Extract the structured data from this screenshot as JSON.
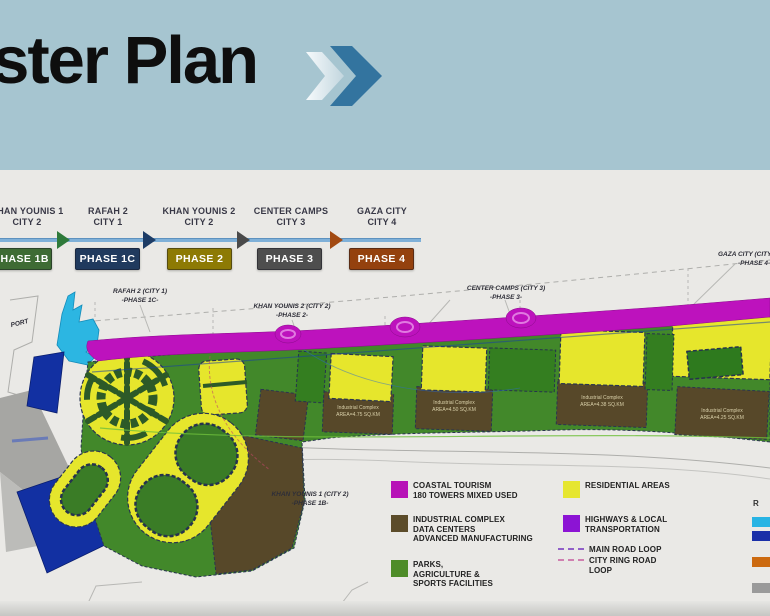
{
  "title": {
    "text": "Master Plan"
  },
  "timeline": {
    "items": [
      {
        "city_line1": "KHAN YOUNIS 1",
        "city_line2": "CITY 2",
        "phase": "PHASE 1B",
        "box_color": "#3e6b34"
      },
      {
        "city_line1": "RAFAH 2",
        "city_line2": "CITY 1",
        "phase": "PHASE 1C",
        "box_color": "#203a5e"
      },
      {
        "city_line1": "KHAN YOUNIS 2",
        "city_line2": "CITY 2",
        "phase": "PHASE 2",
        "box_color": "#8d7a04"
      },
      {
        "city_line1": "CENTER CAMPS",
        "city_line2": "CITY 3",
        "phase": "PHASE 3",
        "box_color": "#4e4e4e"
      },
      {
        "city_line1": "GAZA CITY",
        "city_line2": "CITY 4",
        "phase": "PHASE 4",
        "box_color": "#94410e"
      }
    ]
  },
  "map": {
    "labels": {
      "port": "PORT",
      "rafah_l1": "RAFAH 2 (CITY 1)",
      "rafah_l2": "-PHASE 1C-",
      "ky2_l1": "KHAN YOUNIS 2 (CITY 2)",
      "ky2_l2": "-PHASE 2-",
      "cc_l1": "CENTER CAMPS (CITY 3)",
      "cc_l2": "-PHASE 3-",
      "gaza_l1": "GAZA CITY (CITY 4)",
      "gaza_l2": "-PHASE 4-",
      "ky1_l1": "KHAN YOUNIS 1 (CITY 2)",
      "ky1_l2": "-PHASE 1B-"
    },
    "industrial": [
      {
        "l1": "Industrial Complex",
        "l2": "AREA=4.75 SQ.KM"
      },
      {
        "l1": "Industrial Complex",
        "l2": "AREA=4.50 SQ.KM"
      },
      {
        "l1": "Industrial Complex",
        "l2": "AREA=4.38 SQ.KM"
      },
      {
        "l1": "Industrial Complex",
        "l2": "AREA=4.25 SQ.KM"
      }
    ],
    "region_colors": {
      "coastal_tourism": "#bd12bd",
      "residential": "#e6e62c",
      "parks_agriculture": "#42882a",
      "industrial": "#574829",
      "port_water": "#2cb6e2",
      "blue_zone": "#1230a2",
      "gray_zone": "#a6a6a3"
    }
  },
  "legend": {
    "coastal": {
      "swatch": "#b712b7",
      "l1": "COASTAL TOURISM",
      "l2": "180 TOWERS MIXED USED"
    },
    "residential": {
      "swatch": "#e6e630",
      "l1": "RESIDENTIAL AREAS"
    },
    "industrial": {
      "swatch": "#5c4c2a",
      "l1": "INDUSTRIAL COMPLEX",
      "l2": "DATA CENTERS",
      "l3": "ADVANCED MANUFACTURING"
    },
    "highways": {
      "swatch": "#8c14d4",
      "l1": "HIGHWAYS & LOCAL",
      "l2": "TRANSPORTATION"
    },
    "main_road": {
      "line_color": "#9060c8",
      "l1": "MAIN ROAD LOOP"
    },
    "ring_road": {
      "line_color": "#d080b0",
      "l1": "CITY RING ROAD",
      "l2": "LOOP"
    },
    "parks": {
      "swatch": "#4e8c28",
      "l1": "PARKS,",
      "l2": "AGRICULTURE &",
      "l3": "SPORTS FACILITIES"
    },
    "right_partial": {
      "title": "R",
      "swatch_colors": [
        "#28b4e4",
        "#1a2fa8",
        "#cc6a10",
        "#9a9a9a"
      ]
    }
  }
}
